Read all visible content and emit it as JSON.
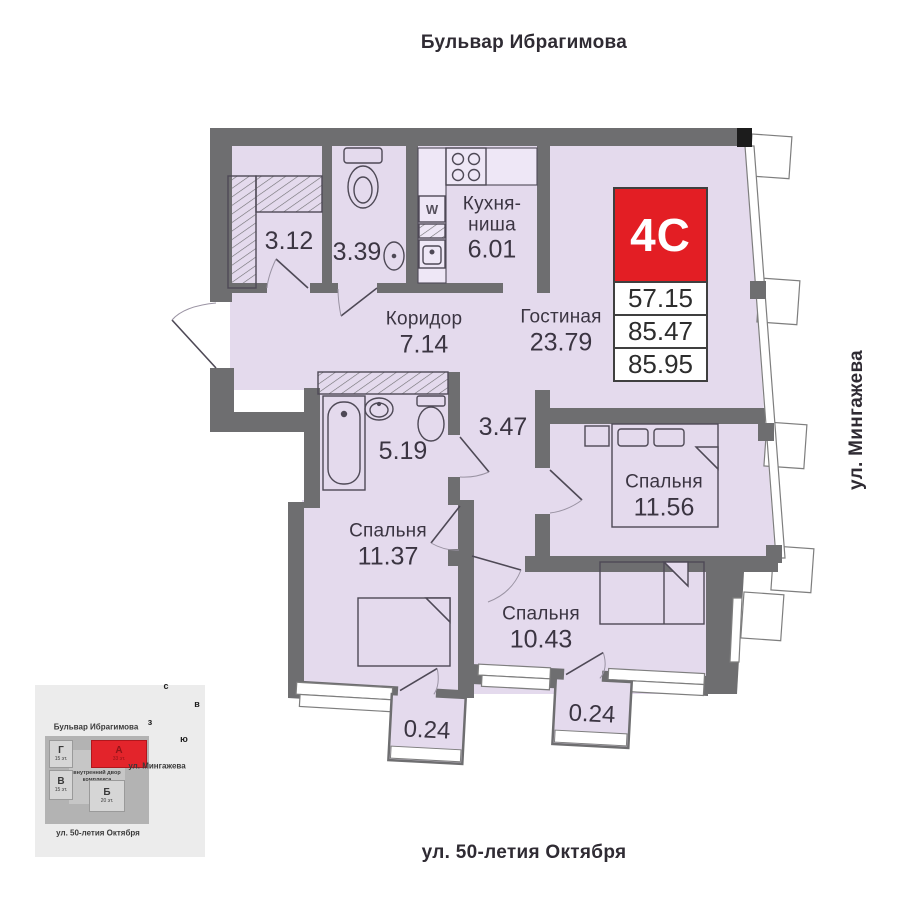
{
  "streets": {
    "top": "Бульвар Ибрагимова",
    "right": "ул. Мингажева",
    "bottom": "ул. 50-летия Октября"
  },
  "unit": {
    "label": "4C",
    "areas": [
      "57.15",
      "85.47",
      "85.95"
    ]
  },
  "rooms": {
    "wardrobe": {
      "area": "3.12"
    },
    "wc": {
      "area": "3.39"
    },
    "kitchen": {
      "name": "Кухня-ниша",
      "area": "6.01"
    },
    "corridor": {
      "name": "Коридор",
      "area": "7.14"
    },
    "living": {
      "name": "Гостиная",
      "area": "23.79"
    },
    "bathroom": {
      "area": "5.19"
    },
    "hall": {
      "area": "3.47"
    },
    "bedroom1": {
      "name": "Спальня",
      "area": "11.56"
    },
    "bedroom2": {
      "name": "Спальня",
      "area": "11.37"
    },
    "bedroom3": {
      "name": "Спальня",
      "area": "10.43"
    },
    "balcony1": {
      "area": "0.24"
    },
    "balcony2": {
      "area": "0.24"
    }
  },
  "plan": {
    "washer_label": "W"
  },
  "colors": {
    "wall": "#6e6e70",
    "floor": "#e4daed",
    "accent_red": "#e31e24"
  },
  "minimap": {
    "street_top": "Бульвар Ибрагимова",
    "street_right": "ул. Мингажева",
    "street_bottom": "ул. 50-летия Октября",
    "courtyard": "внутренний двор комплекса",
    "buildings": [
      {
        "label": "Г",
        "floors": "15 эт."
      },
      {
        "label": "В",
        "floors": "15 эт."
      },
      {
        "label": "А",
        "floors": "33 эт."
      },
      {
        "label": "Б",
        "floors": "20 эт."
      }
    ],
    "compass": {
      "n": "с",
      "e": "в",
      "s": "ю",
      "w": "з"
    }
  }
}
